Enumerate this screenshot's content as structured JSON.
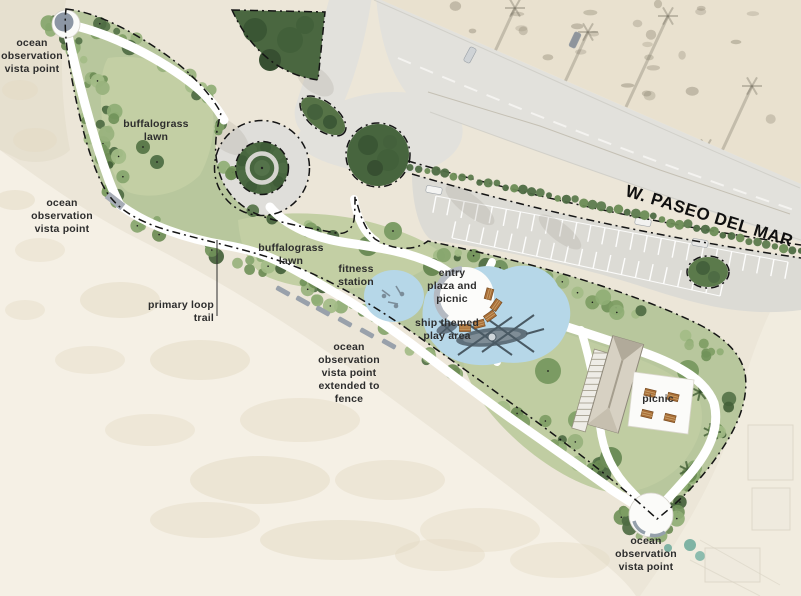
{
  "map": {
    "type": "park site plan over aerial photo",
    "labels": {
      "vista_nw": "ocean\nobservation\nvista point",
      "lawn_nw": "buffalograss\nlawn",
      "vista_w": "ocean\nobservation\nvista point",
      "lawn_center": "buffalograss\nlawn",
      "primary_trail": "primary loop\ntrail",
      "fitness": "fitness\nstation",
      "entry_plaza": "entry\nplaza and\npicnic",
      "play_area": "ship themed\nplay area",
      "vista_sw_fence": "ocean\nobservation\nvista point\nextended to\nfence",
      "picnic": "picnic",
      "vista_se": "ocean\nobservation\nvista point",
      "road": "W. PASEO DEL MAR"
    },
    "palette": {
      "park_green": "#b8c79d",
      "lawn_green": "#c3cfa4",
      "tree_green": "#7e9d64",
      "dense_planting_green": "#47653e",
      "play_area_blue": "#b6d7e8",
      "path_white": "#ffffff",
      "pavement_gray": "#e2e1dc",
      "sand_beige": "#f5f0e5",
      "boundary_black": "#151515",
      "picnic_table_brown": "#aa6f38",
      "label_color": "#2d2d2d"
    }
  }
}
